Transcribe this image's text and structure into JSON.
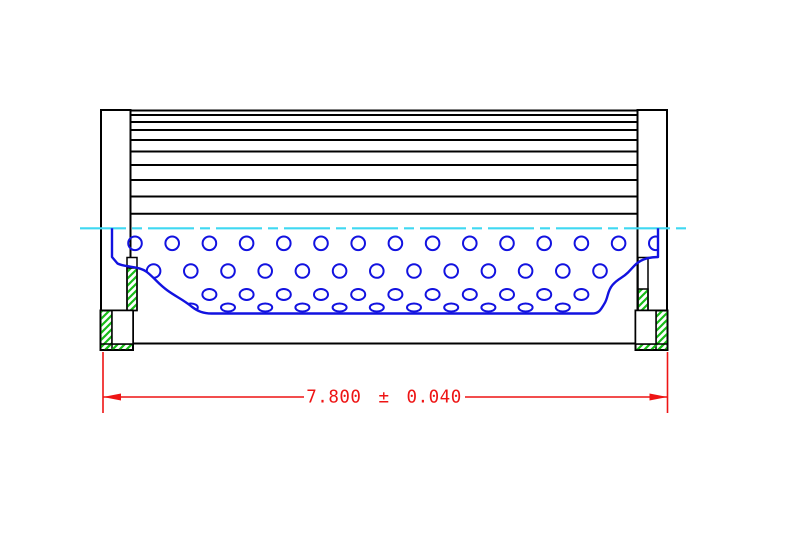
{
  "drawing": {
    "title": "filter-element-cross-section",
    "dimension": {
      "label": "7.800 ± 0.040",
      "value": "7.800",
      "tolerance": "0.040"
    },
    "colors": {
      "background": "#FFFFFF",
      "outline": "#000000",
      "core_blue": "#1212E0",
      "centerline_cyan": "#3FD8F2",
      "hatch_green": "#17BC17",
      "dimension_red": "#EE1414"
    },
    "canvas": {
      "width": 789,
      "height": 546
    },
    "pleats": {
      "x1": 130.5,
      "x2": 638,
      "line_ys": [
        110.5,
        115,
        122,
        130,
        140,
        151.5,
        165,
        180,
        196.5,
        213.8
      ],
      "stroke_w": 2
    },
    "caps": {
      "left": {
        "x": 101,
        "y": 110,
        "w": 29.5,
        "h": 200.5
      },
      "right": {
        "x": 637.5,
        "y": 110,
        "w": 29.5,
        "h": 200.5
      }
    },
    "seams": {
      "left": {
        "x": 127,
        "y": 257.5,
        "w": 10,
        "h": 53,
        "hatch_y": 268
      },
      "right": {
        "x": 638,
        "y": 257.5,
        "w": 10,
        "h": 53,
        "hatch_y": 289
      }
    },
    "feet": {
      "left": {
        "x": 100.5,
        "y": 310.5,
        "w": 32.5,
        "h": 39.5,
        "side": "left",
        "side_w": 11.5,
        "bottom_h": 6
      },
      "right": {
        "x": 635.5,
        "y": 310.5,
        "w": 32,
        "h": 39.5,
        "side": "right",
        "side_w": 11.5,
        "bottom_h": 6
      }
    },
    "base_line": {
      "x1": 133,
      "x2": 635.5,
      "y": 343.5
    },
    "centerline": {
      "x1": 80,
      "x2": 690,
      "y": 228.3,
      "dash": "46 6 10 6"
    },
    "core": {
      "outline_path": "M 112 228.3 L 112 257 L 117.5 263.5 C 127 268 139 265.5 147.5 272.5 C 156 279.5 158.5 284 167.5 290.5 C 176.5 297 183 299.5 191.5 306.5 C 198 311.5 203.5 313.5 211.5 313.5 L 592 313.5 C 599.5 313.5 601 309 604.5 303.5 C 608.5 297 607 291.5 612.5 285 C 618.5 278 622 278.5 628 272.5 C 634.5 266 636 262.5 643.5 259.5 C 650 257 654 257.3 658 257 L 658 228.3",
      "stroke_w": 2.4
    },
    "perforations": {
      "stroke_w": 2,
      "rows": [
        {
          "cy": 243.3,
          "rx": 6.8,
          "ry": 6.8,
          "start_x": 135,
          "pitch": 37.2,
          "count": 15
        },
        {
          "cy": 271,
          "rx": 6.8,
          "ry": 6.8,
          "start_x": 153.6,
          "pitch": 37.2,
          "count": 13
        },
        {
          "cy": 294.5,
          "rx": 7,
          "ry": 5.5,
          "start_x": 209.4,
          "pitch": 37.2,
          "count": 11
        },
        {
          "cy": 307.5,
          "rx": 7,
          "ry": 4,
          "start_x": 190.8,
          "pitch": 37.2,
          "count": 11
        }
      ]
    },
    "dim": {
      "ext_x1": 103,
      "ext_x2": 667.5,
      "ext_y1": 352,
      "ext_y2": 413,
      "line_y": 397,
      "gap_x1": 304,
      "gap_x2": 465,
      "text_x": 384,
      "text_y": 397.5,
      "font_size": 17.5,
      "word_spacing": 6,
      "arrow_len": 18,
      "arrow_half": 3.5,
      "stroke_w": 1.6
    }
  }
}
